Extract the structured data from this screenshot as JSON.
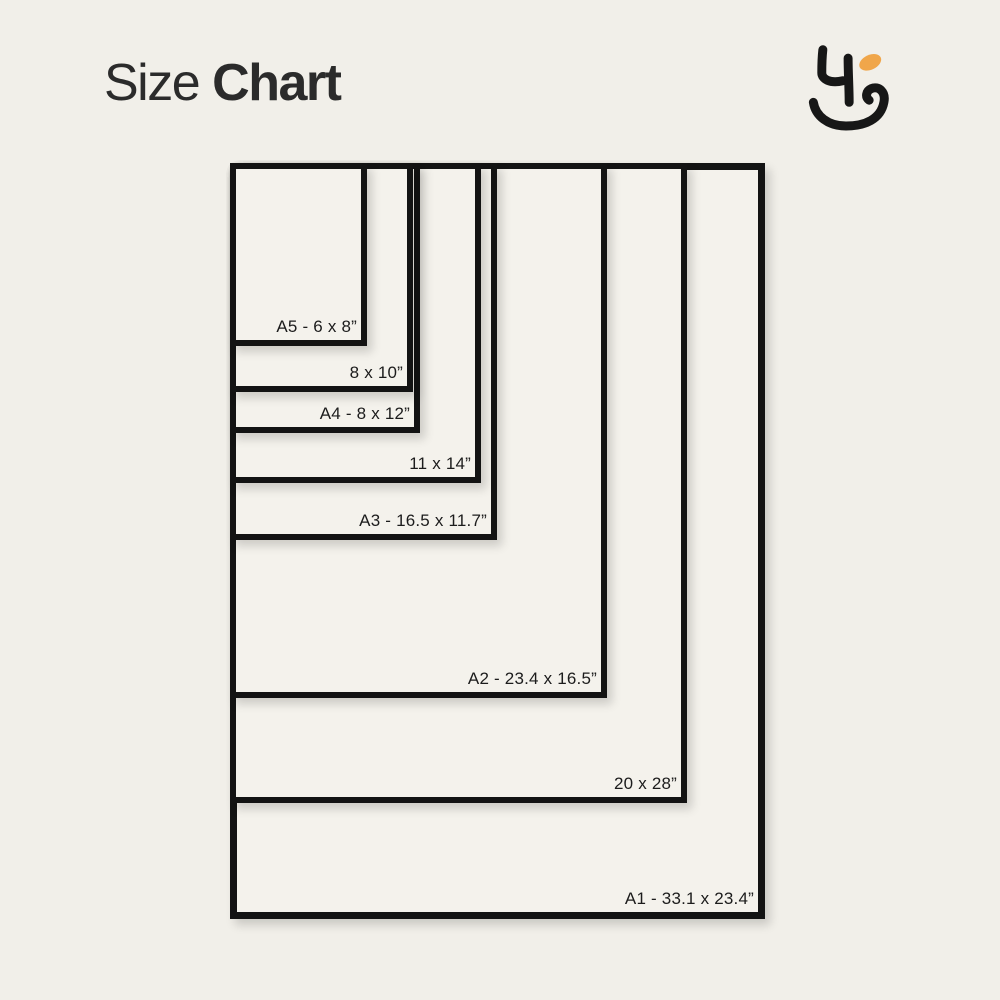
{
  "page": {
    "background_color": "#F1EFE9",
    "title": {
      "regular": "Size",
      "bold": "Chart"
    }
  },
  "logo": {
    "name": "brand-monogram",
    "ink_color": "#171717",
    "accent_color": "#F0A64A"
  },
  "chart": {
    "type": "nested-size-diagram",
    "unit": "inches",
    "anchor": "top-left",
    "frame_color": "#131313",
    "fill_color": "#F4F2EC",
    "label_color": "#1C1C1C",
    "sizes": [
      {
        "id": "A1",
        "label": "A1 - 33.1 x 23.4”",
        "width_in": 23.4,
        "height_in": 33.1
      },
      {
        "id": "20x28",
        "label": "20 x 28”",
        "width_in": 20,
        "height_in": 28
      },
      {
        "id": "A2",
        "label": "A2 - 23.4 x 16.5”",
        "width_in": 16.5,
        "height_in": 23.4
      },
      {
        "id": "A3",
        "label": "A3 - 16.5 x 11.7”",
        "width_in": 11.7,
        "height_in": 16.5
      },
      {
        "id": "11x14",
        "label": "11 x 14”",
        "width_in": 11,
        "height_in": 14
      },
      {
        "id": "A4",
        "label": "A4 - 8 x 12”",
        "width_in": 8.3,
        "height_in": 11.8
      },
      {
        "id": "8x10",
        "label": "8 x 10”",
        "width_in": 8,
        "height_in": 10
      },
      {
        "id": "A5",
        "label": "A5 - 6 x 8”",
        "width_in": 6,
        "height_in": 8
      }
    ]
  }
}
